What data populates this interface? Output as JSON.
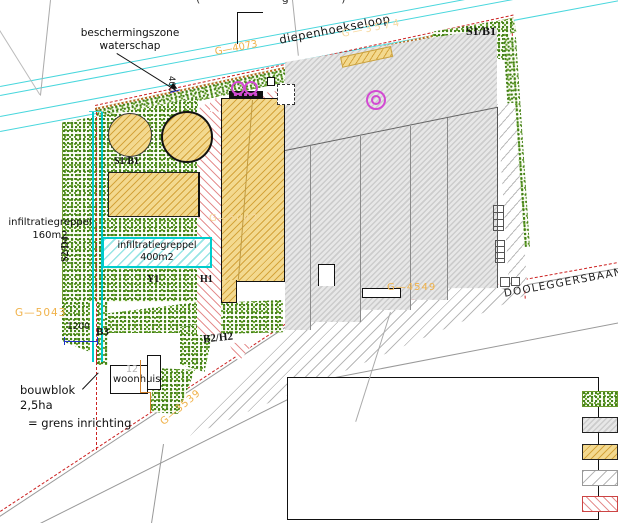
{
  "labels": {
    "top_clipped": "( ˙ ˙ g ˙ )",
    "stream": "diepenhoekseloop",
    "road": "DOOLEGGERSBAAN",
    "protection_zone_line1": "beschermingszone",
    "protection_zone_line2": "waterschap",
    "dim_protection": "400",
    "dim_left": "1200",
    "infiltration_left_line1": "infiltratiegreppel",
    "infiltration_left_line2": "160m2",
    "infiltration_box_line1": "infiltratiegreppel",
    "infiltration_box_line2": "400m2",
    "bouwblok_line1": "bouwblok",
    "bouwblok_line2": "2,5ha",
    "bouwblok_line3": "= grens inrichting",
    "house": "woonhuis",
    "house_number": "12"
  },
  "zone_codes": {
    "s1b1_top": "S1/B1",
    "s1b1_left": "S1/B1",
    "s2d4": "S2/D4",
    "y1": "Y1",
    "h1": "H1",
    "b3": "B3",
    "b2h2": "B2/H2"
  },
  "parcel_codes": {
    "g4073": "G—4073",
    "g3574": "G—3574",
    "g5043": "G—5043",
    "g5042": "G—5042",
    "g4549": "G—4549",
    "g3539": "G—3539"
  },
  "legend": {
    "items": [
      {
        "label": "Erfbeplanting",
        "type": "stipple-green"
      },
      {
        "label": "bestaande bebouwing",
        "type": "gray-hatch"
      },
      {
        "label": "nieuwe bebouwing",
        "type": "tan-hatch"
      },
      {
        "label": "bestaande verharding",
        "type": "light-gray-hatch"
      },
      {
        "label": "nieuwe verharding",
        "type": "red-hatch"
      }
    ]
  },
  "colors": {
    "stream_cyan": "#49d7dd",
    "trench_cyan": "#00cccc",
    "magenta": "#d24ad2",
    "label_orange": "#f0b24a",
    "label_pale_orange": "#f6d9a0",
    "boundary_red": "#cc2222",
    "red_hatch": "#e59090",
    "tan_fill": "#f3d98f",
    "building_fill": "#dcdcdc",
    "planting_green": "#3f7d14",
    "dimension_blue": "#2233cc",
    "parcel_orange": "#d2822d",
    "road_gray": "#9a9a9a"
  }
}
